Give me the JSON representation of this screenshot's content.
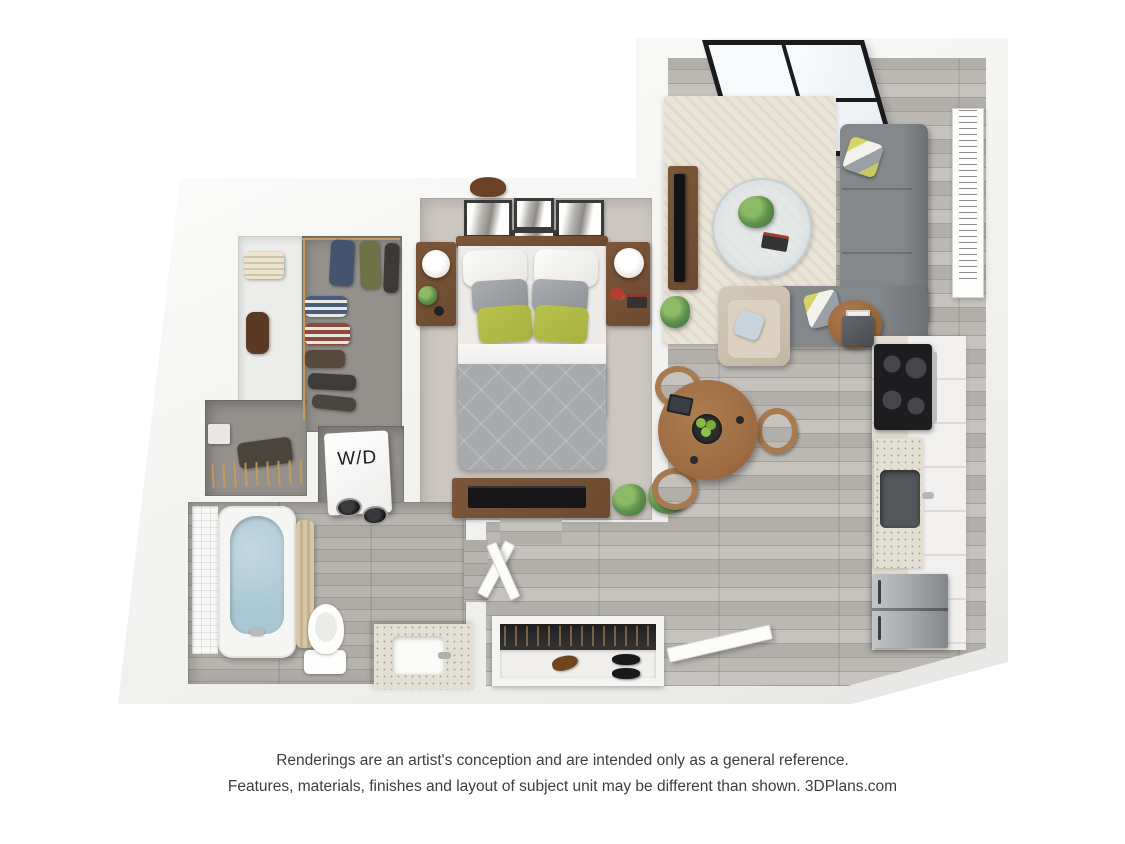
{
  "labels": {
    "washer_dryer": "W/D"
  },
  "disclaimer": {
    "line1": "Renderings are an artist's conception and are intended only as a general reference.",
    "line2": "Features, materials, finishes and layout of subject unit may be different than shown. 3DPlans.com"
  },
  "colors": {
    "woodA": "#c6c3be",
    "woodB": "#b2afaa",
    "woodC": "#bcb9b4",
    "woodSeam": "#a3a09b",
    "carpet": "#ccc6c0",
    "closetFloor": "#94908c",
    "rug": "#eae4d7",
    "sofa": "#85888b",
    "sofaDark": "#6e7174",
    "duvet": "#a7aaad",
    "pillowGreen": "#a9b23f",
    "woodBrown": "#6d4a30",
    "tableWood": "#9b6a41",
    "water": "#a9c7d4",
    "curtain": "#d7c7a6",
    "porcelain": "#fdfdfc",
    "speckle": "#e3dfd3",
    "steel": "#9ea2a5",
    "plant": "#5f9150",
    "plantDark": "#3f6e36",
    "hanger": "#c99a5b",
    "textGray": "#3e3e3e"
  }
}
